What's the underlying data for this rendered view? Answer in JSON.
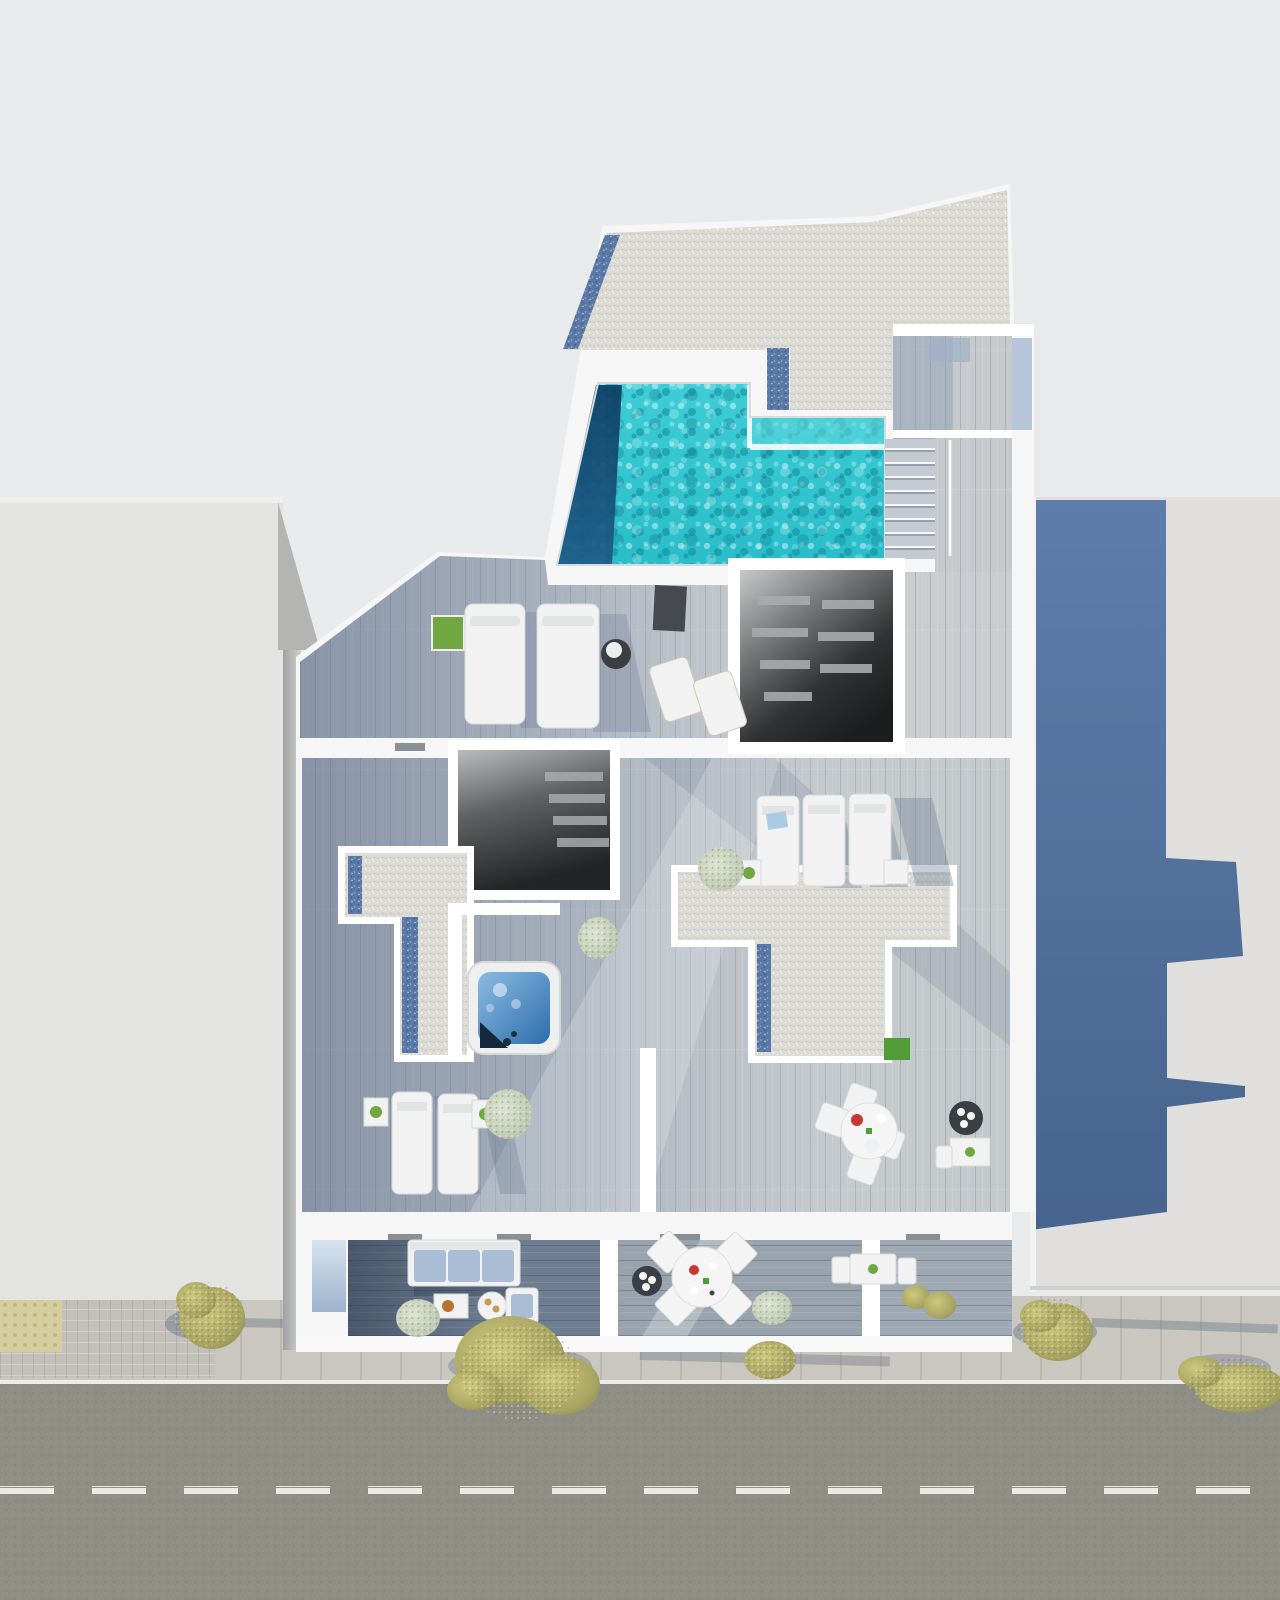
{
  "meta": {
    "kind": "architectural-3d-render",
    "view": "top-down aerial",
    "description": "Photorealistic bird's-eye render of a modern rooftop level with swimming pool, gravel roofs, wood-deck terraces, jacuzzi, sun loungers, balconies and a street with sidewalk trees below; neighbouring buildings left and right.",
    "image_size": {
      "width": 1280,
      "height": 1600
    }
  },
  "colors": {
    "bg": "#e8eaec",
    "leftbuilding": "#e3e3e1",
    "leftbuildingwedge": "#b4b5b3",
    "sliver": "#d0d1cf",
    "rightbuilding": "#e0dfdd",
    "shadowbluetop": "#5e7dab",
    "shadowbluebottom": "#47648e",
    "whitewall": "#f5f6f5",
    "gravel": "#dcdad4",
    "bluespeck": "#5b79a6",
    "pooltop": "#3ecdd6",
    "poolbottom": "#28bdc9",
    "pooldeep1": "#0f3c63",
    "pooldeep2": "#1e5b86",
    "poolshelf": "#5fd6da",
    "decklight": "#c9cdd0",
    "deckmid": "#c4c9cc",
    "corridorwood": "#c6cacd",
    "balcleft": "#6e7d91",
    "balcmid": "#98a3ae",
    "balcright": "#9fa9b4",
    "openlight": "#c6c8ca",
    "opendark": "#1b1d1f",
    "slat": "#a7abae",
    "jacuzzi1": "#8cbbe2",
    "jacuzzi2": "#2e6dac",
    "jacuzziseat": "#16293c",
    "glass1": "#d7e3f0",
    "glass2": "#9db3cd",
    "bluestub": "#b7c5d8",
    "street": "#8f8e85",
    "curb": "#ebebe7",
    "dash": "#eceae2",
    "sidewalk": "#c9c7c0",
    "tileline": "#b6b4ad",
    "sett": "#c2c0b9",
    "tactile": "#d6cd9f",
    "tactiledot": "#c0b67f",
    "tree1": "#cdc87e",
    "tree2": "#a9a562",
    "tree3": "#908c52",
    "bushpale1": "#dde3d3",
    "bushpale2": "#b3bfa4",
    "grass": "#4f9c38",
    "plantgreen": "#6fa842",
    "sofacushion": "#a9bdd4",
    "towelblue": "#a9cbe4",
    "planterdark": "#3a3f45",
    "furnwhite": "#f1f2f1",
    "furnstroke": "#d8dada",
    "accentred": "#c8382e",
    "accentgreen": "#4e9c3b",
    "accentorange": "#b8742f",
    "matdark": "#46494d"
  },
  "scene": {
    "buildings": [
      {
        "name": "left-neighbour-building"
      },
      {
        "name": "right-neighbour-building",
        "shadow": "cast by main building"
      },
      {
        "name": "main-building-roof-level"
      }
    ],
    "pool": {
      "shape": "rectangular with shallow shelf",
      "deep_edge": "left"
    },
    "counts": {
      "sun_loungers": 7,
      "deck_chairs": 2,
      "round_dining_sets": 2,
      "small_tables": 6,
      "sofas": 1,
      "armchairs": 1,
      "jacuzzis": 1,
      "roof_openings": 2,
      "gravel_patches": 3,
      "sidewalk_trees": 5,
      "street_dashes": 14
    }
  }
}
